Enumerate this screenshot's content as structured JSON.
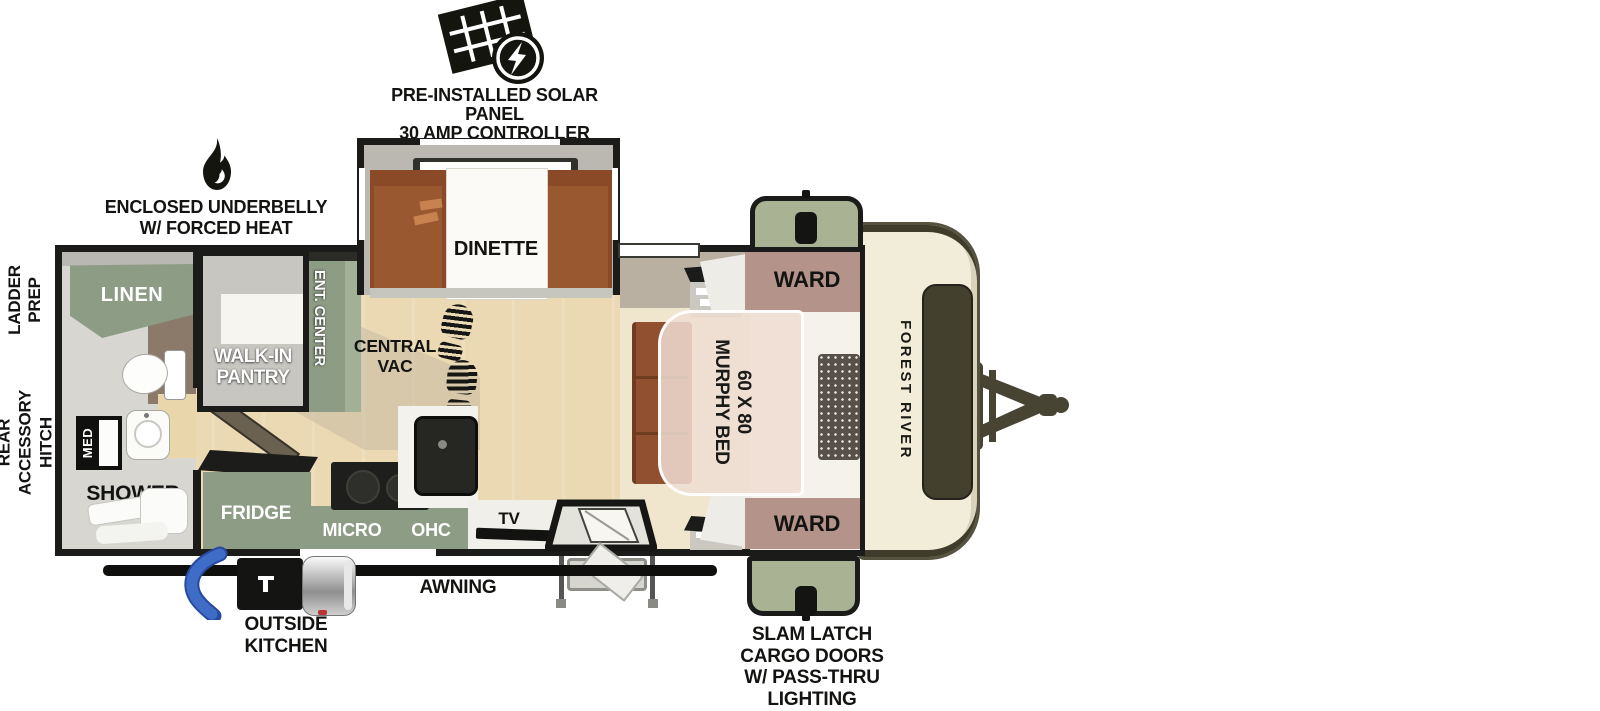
{
  "callouts": {
    "solar": {
      "lines": [
        "PRE-INSTALLED SOLAR PANEL",
        "30 AMP CONTROLLER",
        "& INVERTER PREP"
      ]
    },
    "underbelly": {
      "lines": [
        "ENCLOSED UNDERBELLY",
        "W/ FORCED HEAT"
      ]
    },
    "ladder_prep": {
      "lines": [
        "LADDER",
        "PREP"
      ]
    },
    "rear_hitch": {
      "lines": [
        "REAR",
        "ACCESSORY",
        "HITCH"
      ]
    },
    "awning": "AWNING",
    "outside_kitchen": {
      "lines": [
        "OUTSIDE",
        "KITCHEN"
      ]
    },
    "cargo_doors": {
      "lines": [
        "SLAM LATCH",
        "CARGO DOORS",
        "W/ PASS-THRU",
        "LIGHTING"
      ]
    }
  },
  "labels": {
    "linen": "LINEN",
    "med": "MED",
    "shower": "SHOWER",
    "pantry": {
      "lines": [
        "WALK-IN",
        "PANTRY"
      ]
    },
    "ent_center": "ENT. CENTER",
    "dinette": "DINETTE",
    "central_vac": {
      "lines": [
        "CENTRAL",
        "VAC"
      ]
    },
    "fridge": "FRIDGE",
    "micro": "MICRO",
    "ohc": "OHC",
    "tv": "TV",
    "ward_top": "WARD",
    "ward_bottom": "WARD",
    "murphy_bed": {
      "lines": [
        "60 X 80",
        "MURPHY BED"
      ]
    },
    "brand": "FOREST RIVER"
  },
  "colors": {
    "cabinet_green": "#8d9c85",
    "cargo_door_green": "#a9b293",
    "ward_mauve": "#b3938a",
    "bench_brown": "#8a4a28",
    "sofa_brown": "#915130",
    "floor_wood": "#ead9b2",
    "bedroom_floor": "#f0e6ce",
    "front_cap_cream": "#f1edd9",
    "outline_black": "#1b1b19",
    "hose_blue": "#3f6cc7"
  }
}
